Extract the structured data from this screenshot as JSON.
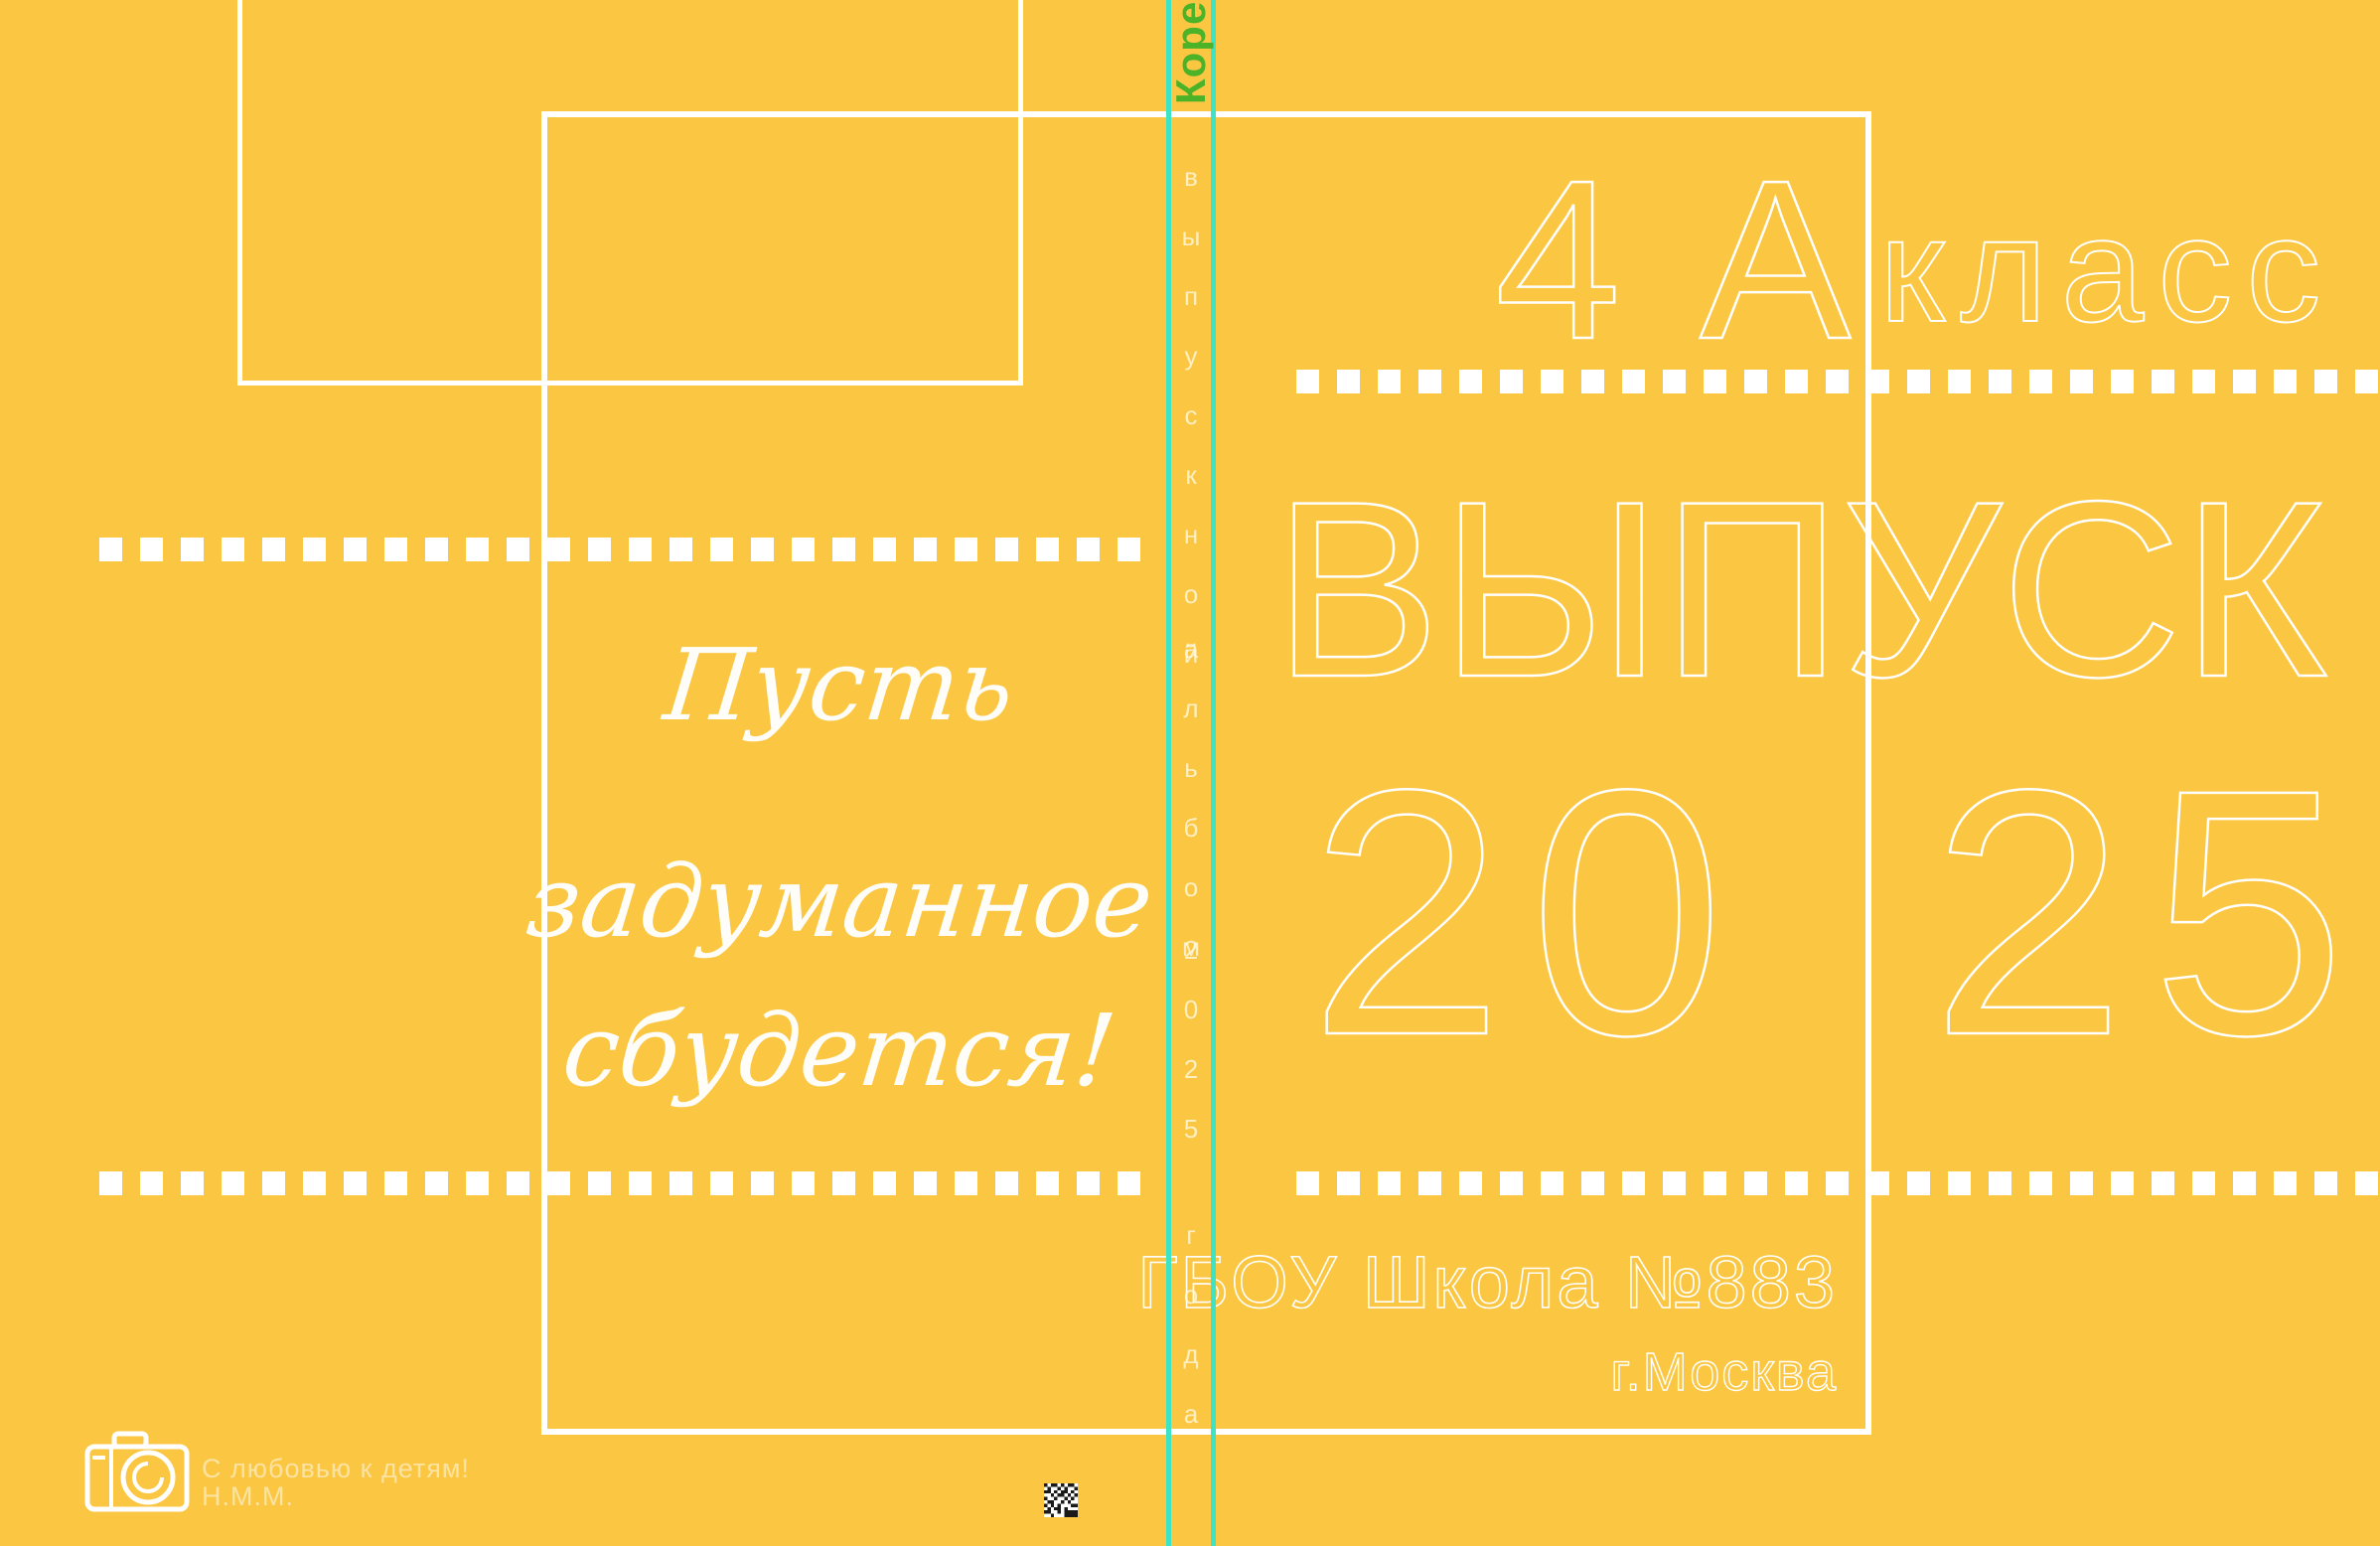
{
  "canvas": {
    "bg": "#FBC743",
    "white": "#FFFFFF",
    "guide_cyan": "#3CE4C5",
    "marker_green": "#4CB227"
  },
  "back_cover": {
    "quote_line1": "Пусть",
    "quote_line2": "задуманное",
    "quote_line3": "сбудется!",
    "credit_line1": "С любовью к детям!",
    "credit_line2": "Н.М.М.",
    "camera_icon": "camera-icon",
    "datamatrix_icon": "datamatrix-code"
  },
  "spine": {
    "marker_label": "Корешок",
    "vertical_words": [
      "выпускной",
      "альбом",
      "2025",
      "года"
    ]
  },
  "front_cover": {
    "class_number": "4 А",
    "class_word": "класс",
    "title": "ВЫПУСК",
    "year_left": "20",
    "year_right": "25",
    "school": "ГБОУ Школа №883",
    "city": "г.Москва"
  }
}
